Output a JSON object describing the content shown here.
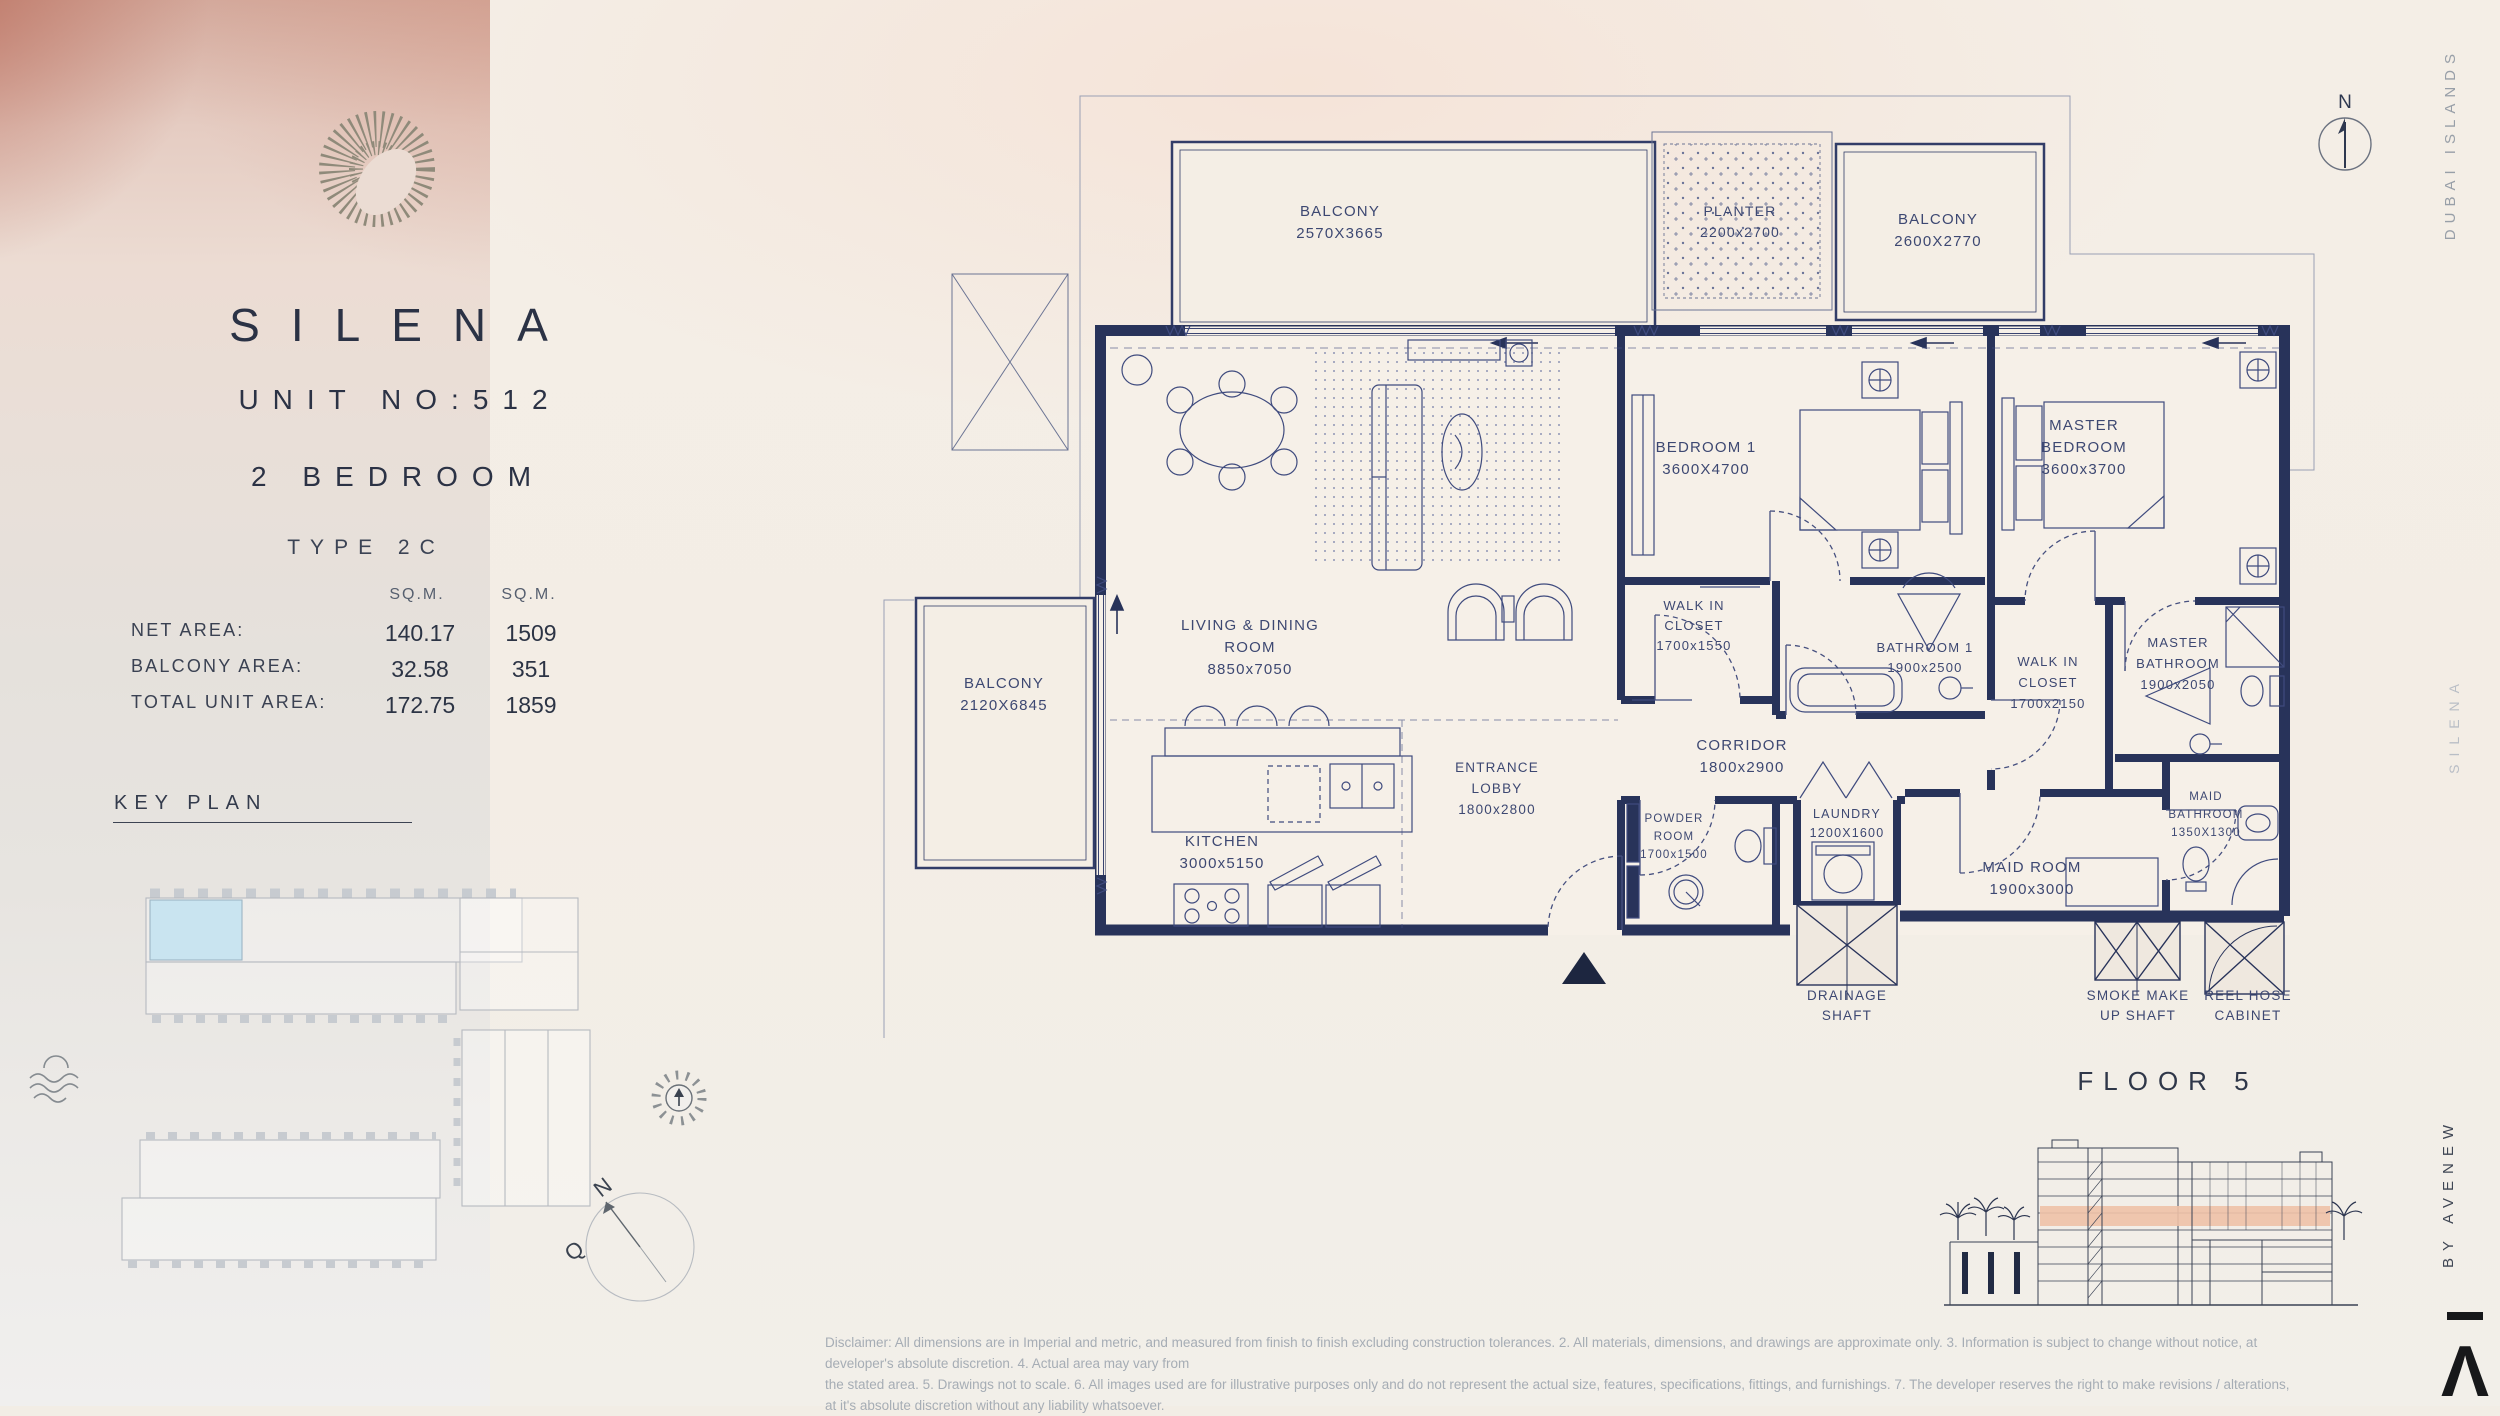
{
  "left_panel": {
    "brand": "SILENA",
    "unit_no": "UNIT NO:512",
    "bedrooms": "2 BEDROOM",
    "unit_type": "TYPE 2C",
    "area_table": {
      "col1_header": "SQ.M.",
      "col2_header": "SQ.M.",
      "rows": [
        {
          "label": "NET AREA:",
          "sqm": "140.17",
          "sqft": "1509"
        },
        {
          "label": "BALCONY AREA:",
          "sqm": "32.58",
          "sqft": "351"
        },
        {
          "label": "TOTAL UNIT AREA:",
          "sqm": "172.75",
          "sqft": "1859"
        }
      ]
    },
    "key_plan_title": "KEY PLAN",
    "compass": {
      "n": "N",
      "q": "Q"
    }
  },
  "plan": {
    "north_label": "N",
    "rooms": {
      "balcony_tl": [
        "BALCONY",
        "2570X3665"
      ],
      "planter": [
        "PLANTER",
        "2200x2700"
      ],
      "balcony_tr": [
        "BALCONY",
        "2600X2770"
      ],
      "bedroom1": [
        "BEDROOM 1",
        "3600X4700"
      ],
      "master_bedroom": [
        "MASTER",
        "BEDROOM",
        "3600x3700"
      ],
      "balcony_left": [
        "BALCONY",
        "2120X6845"
      ],
      "living": [
        "LIVING & DINING",
        "ROOM",
        "8850x7050"
      ],
      "kitchen": [
        "KITCHEN",
        "3000x5150"
      ],
      "entrance": [
        "ENTRANCE",
        "LOBBY",
        "1800x2800"
      ],
      "wic1": [
        "WALK IN",
        "CLOSET",
        "1700x1550"
      ],
      "bath1": [
        "BATHROOM 1",
        "1900x2500"
      ],
      "wic2": [
        "WALK IN",
        "CLOSET",
        "1700x2150"
      ],
      "master_bath": [
        "MASTER",
        "BATHROOM",
        "1900x2050"
      ],
      "corridor": [
        "CORRIDOR",
        "1800x2900"
      ],
      "powder": [
        "POWDER",
        "ROOM",
        "1700x1500"
      ],
      "laundry": [
        "LAUNDRY",
        "1200X1600"
      ],
      "maid_room": [
        "MAID ROOM",
        "1900x3000"
      ],
      "maid_bath": [
        "MAID",
        "BATHROOM",
        "1350X1300"
      ],
      "drainage_shaft": [
        "DRAINAGE",
        "SHAFT"
      ],
      "smoke_shaft": [
        "SMOKE MAKE",
        "UP SHAFT"
      ],
      "reel_hose": [
        "REEL HOSE",
        "CABINET"
      ]
    }
  },
  "right_rail": {
    "location": "DUBAI ISLANDS",
    "brand": "SILENA",
    "developer": "BY AVENEW",
    "logo_glyph": "Λ"
  },
  "floor_section": {
    "title": "FLOOR 5"
  },
  "disclaimer": {
    "line1": "Disclaimer: All dimensions are in Imperial and metric, and measured from finish to finish excluding construction tolerances. 2. All materials, dimensions, and drawings are approximate only. 3. Information is subject to change without notice, at developer's absolute discretion. 4. Actual area may vary from",
    "line2": "the stated area. 5. Drawings not to scale. 6. All images used are for illustrative purposes only and do not represent the actual size, features, specifications, fittings, and furnishings. 7. The developer reserves the right to make revisions / alterations, at it's absolute discretion without any liability whatsoever."
  },
  "colors": {
    "wall_navy": "#28335a",
    "highlight_salmon": "#eec1a7",
    "keyplan_highlight": "#c9e4f0",
    "watercolor_red": "#ac4d3a"
  }
}
